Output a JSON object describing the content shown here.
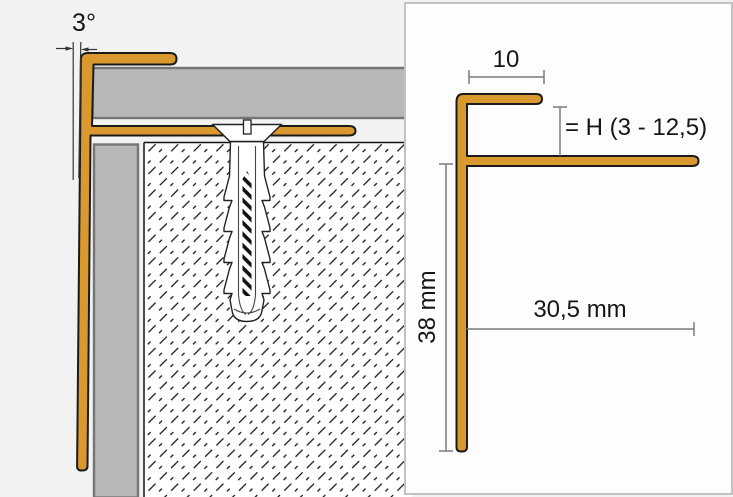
{
  "left_panel": {
    "angle_label": "3°"
  },
  "right_panel": {
    "top_width_label": "10",
    "tile_height_label": "= H (3 - 12,5)",
    "leg_height_label": "38 mm",
    "base_length_label": "30,5 mm"
  },
  "colors": {
    "profile_orange": "#D9992F",
    "tile_gray": "#B7B7B7",
    "tile_outline": "#757575",
    "outline_dark": "#1B1B1B",
    "dim_line": "#7A7A7A",
    "panel_border": "#C2C2C2",
    "panel_background": "#FDFDFD",
    "left_background": "#F2F2F2"
  }
}
